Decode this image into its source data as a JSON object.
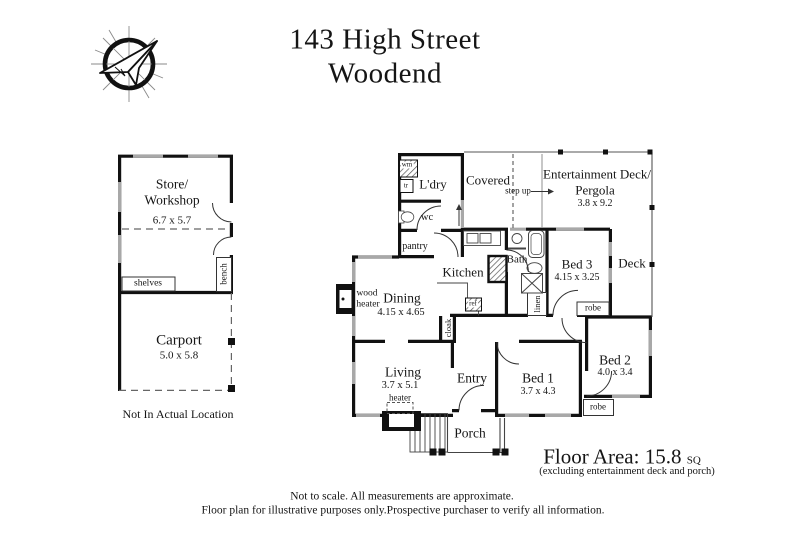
{
  "header": {
    "title_line1": "143 High Street",
    "title_line2": "Woodend"
  },
  "outbuilding": {
    "store_name_line1": "Store/",
    "store_name_line2": "Workshop",
    "store_dims": "6.7 x 5.7",
    "shelves_label": "shelves",
    "bench_label": "bench",
    "carport_name": "Carport",
    "carport_dims": "5.0 x 5.8",
    "location_note": "Not In Actual Location"
  },
  "house": {
    "laundry": "L'dry",
    "washing_machine": "wm",
    "trough": "tr",
    "wc": "wc",
    "pantry": "pantry",
    "covered": "Covered",
    "step_up": "step up",
    "ent_deck_line1": "Entertainment Deck/",
    "ent_deck_line2": "Pergola",
    "ent_deck_dims": "3.8 x 9.2",
    "deck": "Deck",
    "kitchen": "Kitchen",
    "fridge": "ref",
    "bath": "Bath",
    "linen": "linen",
    "bed3": "Bed 3",
    "bed3_dims": "4.15 x 3.25",
    "robe_bed3": "robe",
    "robe_bed2": "robe",
    "wood_heater_line1": "wood",
    "wood_heater_line2": "heater",
    "dining": "Dining",
    "dining_dims": "4.15 x 4.65",
    "cloak": "cloak",
    "living": "Living",
    "living_dims": "3.7 x 5.1",
    "heater": "heater",
    "entry": "Entry",
    "bed1": "Bed 1",
    "bed1_dims": "3.7 x 4.3",
    "bed2": "Bed 2",
    "bed2_dims": "4.0 x 3.4",
    "porch": "Porch"
  },
  "footer": {
    "floor_area_label": "Floor Area: 15.8",
    "floor_area_unit": "SQ",
    "floor_area_note": "(excluding entertainment deck and porch)",
    "disclaimer_line1": "Not to scale. All measurements are approximate.",
    "disclaimer_line2": "Floor plan for illustrative purposes only.Prospective purchaser to verify all information."
  },
  "colors": {
    "wall": "#111111",
    "window": "#a8a8a8",
    "text": "#151515",
    "background": "#ffffff"
  }
}
